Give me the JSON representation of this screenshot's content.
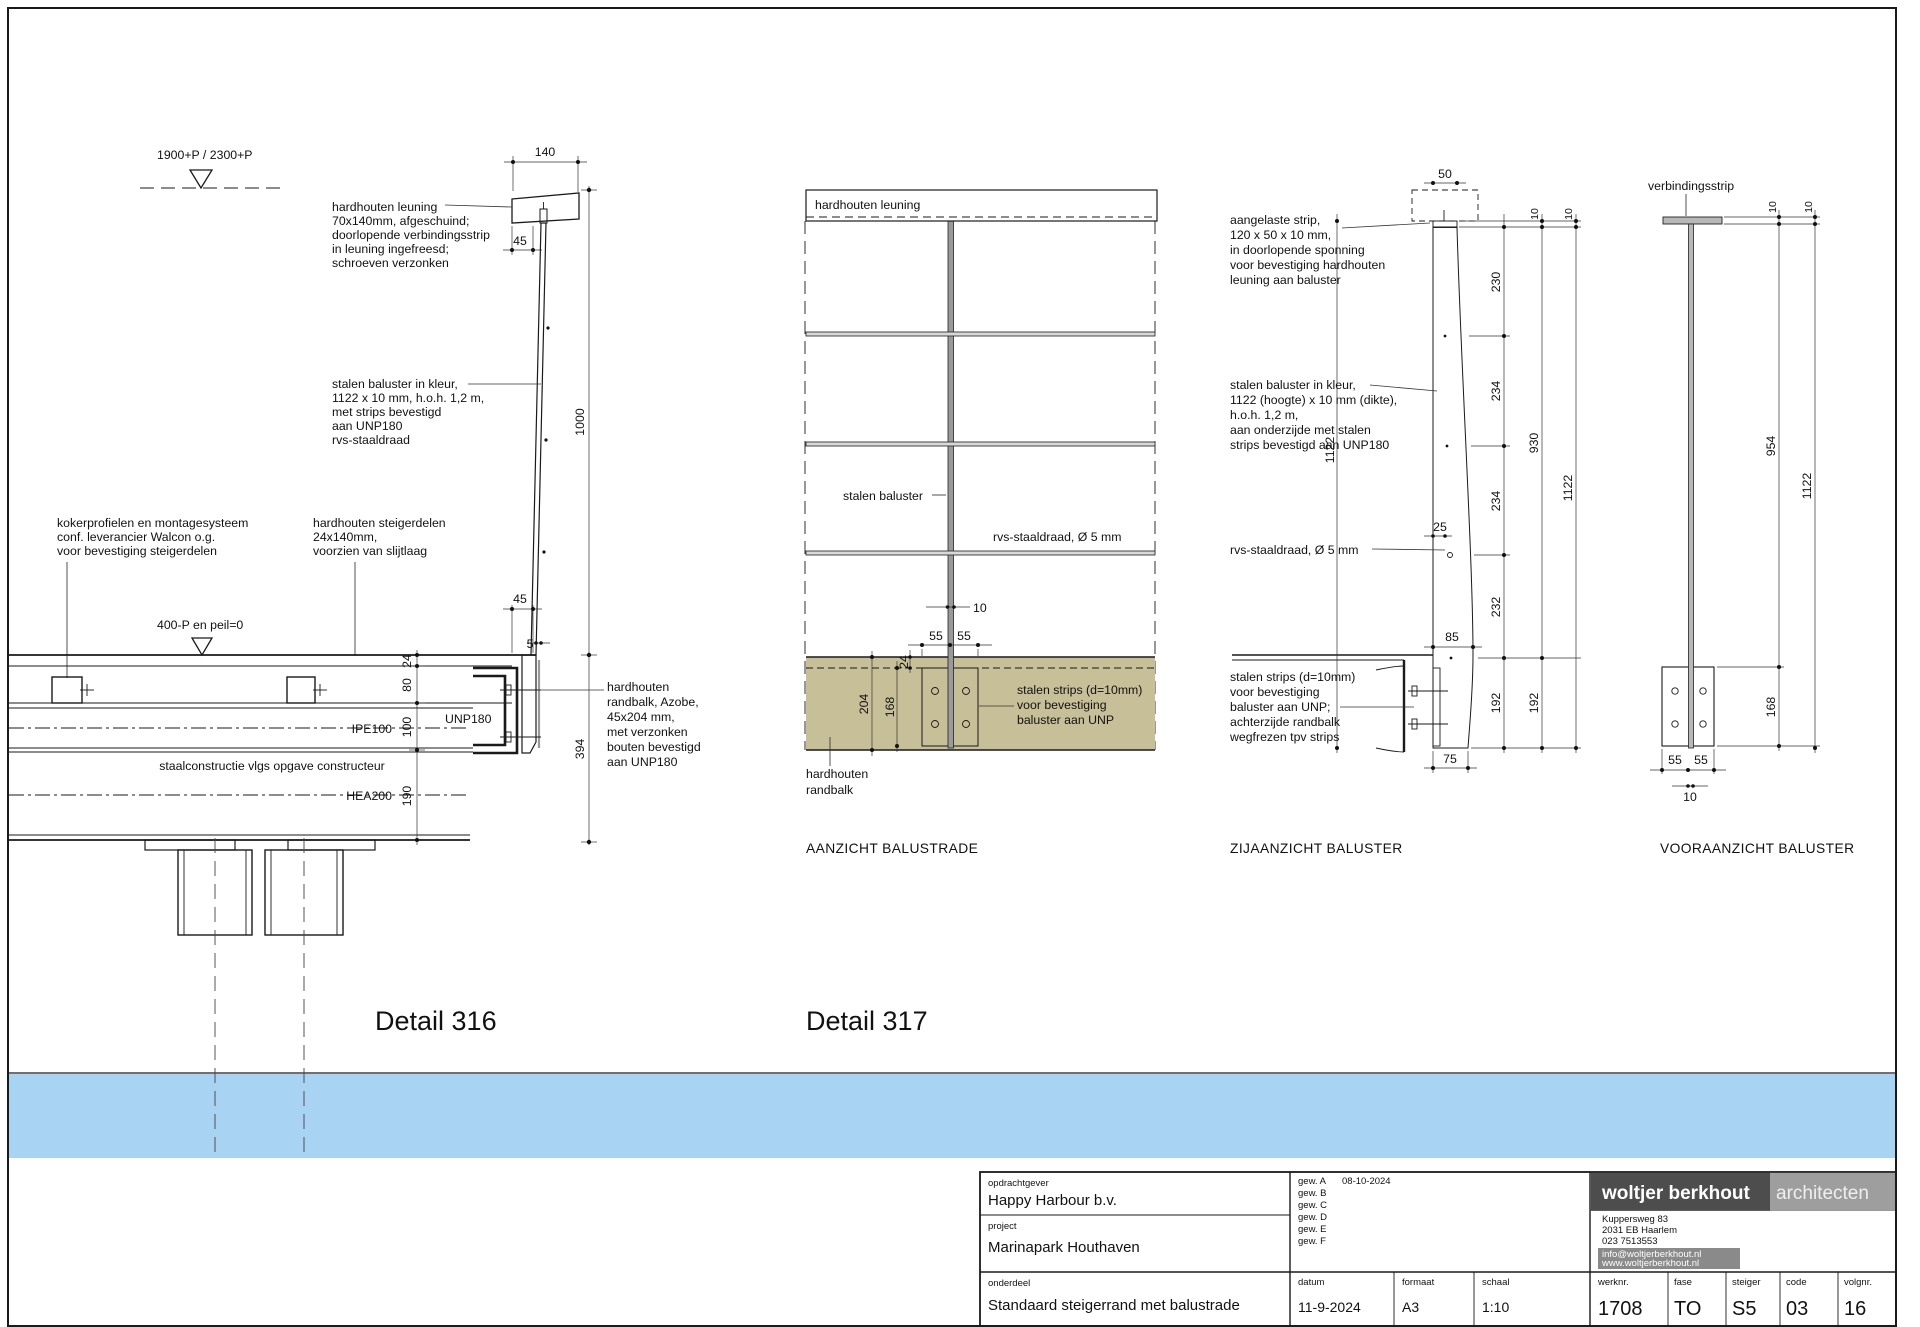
{
  "page": {
    "detail316_title": "Detail 316",
    "detail317_title": "Detail 317"
  },
  "colors": {
    "water": "#a9d3f3",
    "wood": "#c7bf98",
    "steel": "#b5b5b5",
    "baluster_grey": "#c9c9c9",
    "logo_dark": "#4d4d4d",
    "logo_light": "#9e9e9e",
    "address_box": "#8a8a8a"
  },
  "d316": {
    "level_top": "1900+P / 2300+P",
    "level_deck": "400-P en peil=0",
    "leuning_label": [
      "hardhouten leuning",
      "70x140mm, afgeschuind;",
      "doorlopende verbindingsstrip",
      "in leuning ingefreesd;",
      "schroeven verzonken"
    ],
    "baluster_label": [
      "stalen baluster in kleur,",
      "1122 x 10 mm, h.o.h. 1,2 m,",
      "met strips bevestigd",
      "aan UNP180",
      "rvs-staaldraad"
    ],
    "koker_label": [
      "kokerprofielen en montagesysteem",
      "conf. leverancier Walcon o.g.",
      "voor bevestiging steigerdelen"
    ],
    "delen_label": [
      "hardhouten steigerdelen",
      "24x140mm,",
      "voorzien van slijtlaag"
    ],
    "randbalk_label": [
      "hardhouten",
      "randbalk, Azobe,",
      "45x204 mm,",
      "met verzonken",
      "bouten bevestigd",
      "aan UNP180"
    ],
    "staal_note": "staalconstructie vlgs opgave constructeur",
    "ipe": "IPE100",
    "unp": "UNP180",
    "hea": "HEA200",
    "dim_140": "140",
    "dim_45a": "45",
    "dim_1000": "1000",
    "dim_45b": "45",
    "dim_5": "5",
    "dim_24": "24",
    "dim_80": "80",
    "dim_100": "100",
    "dim_190": "190",
    "dim_394": "394"
  },
  "d317": {
    "band": "hardhouten leuning",
    "baluster": "stalen baluster",
    "draad": "rvs-staaldraad, Ø 5 mm",
    "strips_label": [
      "stalen strips (d=10mm)",
      "voor bevestiging",
      "baluster aan UNP"
    ],
    "randbalk_label": [
      "hardhouten",
      "randbalk"
    ],
    "dim_10": "10",
    "dim_55a": "55",
    "dim_55b": "55",
    "dim_24": "24",
    "dim_204": "204",
    "dim_168": "168",
    "caption": "AANZICHT BALUSTRADE"
  },
  "zij": {
    "strip_label": [
      "aangelaste strip,",
      "120 x 50 x 10 mm,",
      "in doorlopende sponning",
      "voor bevestiging hardhouten",
      "leuning aan baluster"
    ],
    "baluster_label": [
      "stalen baluster in kleur,",
      "1122 (hoogte) x 10 mm (dikte),",
      "h.o.h. 1,2 m,",
      "aan onderzijde met stalen",
      "strips bevestigd aan UNP180"
    ],
    "draad": "rvs-staaldraad, Ø 5 mm",
    "strips_label": [
      "stalen strips (d=10mm)",
      "voor bevestiging",
      "baluster aan UNP;",
      "achterzijde randbalk",
      "wegfrezen tpv strips"
    ],
    "dim_50": "50",
    "dim_25": "25",
    "dim_85": "85",
    "dim_75": "75",
    "dim_10a": "10",
    "dim_10b": "10",
    "dim_230": "230",
    "dim_234a": "234",
    "dim_234b": "234",
    "dim_232": "232",
    "dim_930": "930",
    "dim_1122_left": "1122",
    "dim_1122_right": "1122",
    "dim_192a": "192",
    "dim_192b": "192",
    "caption": "ZIJAANZICHT BALUSTER"
  },
  "voor": {
    "label": "verbindingsstrip",
    "dim_10a": "10",
    "dim_10b": "10",
    "dim_954": "954",
    "dim_1122": "1122",
    "dim_168": "168",
    "dim_55a": "55",
    "dim_55b": "55",
    "dim_10c": "10",
    "caption": "VOORAANZICHT BALUSTER"
  },
  "titleblock": {
    "opdrachtgever_label": "opdrachtgever",
    "opdrachtgever": "Happy Harbour b.v.",
    "project_label": "project",
    "project": "Marinapark Houthaven",
    "onderdeel_label": "onderdeel",
    "onderdeel": "Standaard steigerrand met balustrade",
    "gew": [
      "gew. A",
      "gew. B",
      "gew. C",
      "gew. D",
      "gew. E",
      "gew. F"
    ],
    "gew_a_date": "08-10-2024",
    "datum_label": "datum",
    "datum": "11-9-2024",
    "formaat_label": "formaat",
    "formaat": "A3",
    "schaal_label": "schaal",
    "schaal": "1:10",
    "werknr_label": "werknr.",
    "werknr": "1708",
    "fase_label": "fase",
    "fase": "TO",
    "steiger_label": "steiger",
    "steiger": "S5",
    "code_label": "code",
    "code": "03",
    "volgnr_label": "volgnr.",
    "volgnr": "16",
    "firm_name": "woltjer berkhout",
    "firm_suffix": "architecten",
    "address": [
      "Kuppersweg 83",
      "2031 EB Haarlem",
      "023 7513553",
      "info@woltjerberkhout.nl",
      "www.woltjerberkhout.nl"
    ]
  }
}
